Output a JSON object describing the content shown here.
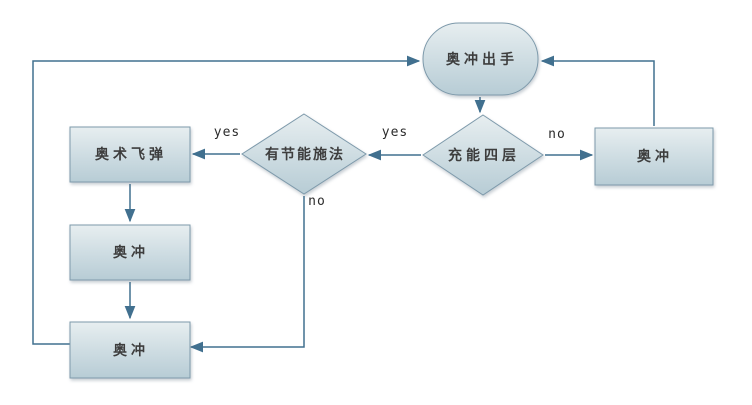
{
  "diagram": {
    "type": "flowchart",
    "background": "#ffffff",
    "colors": {
      "shape_fill_top": "#e7eef0",
      "shape_fill_bottom": "#b7ccd5",
      "shape_border": "#7e9aab",
      "connector": "#41708f",
      "node_text": "#3d3d3d",
      "edge_label_text": "#2b2b2b"
    },
    "nodes": {
      "start": {
        "type": "terminator",
        "label": "奥冲出手"
      },
      "charge_check": {
        "type": "decision",
        "label": "充能四层"
      },
      "clearcast_check": {
        "type": "decision",
        "label": "有节能施法"
      },
      "arcane_missiles": {
        "type": "process",
        "label": "奥术飞弹"
      },
      "surge_mid": {
        "type": "process",
        "label": "奥冲"
      },
      "surge_bottom": {
        "type": "process",
        "label": "奥冲"
      },
      "surge_right": {
        "type": "process",
        "label": "奥冲"
      }
    },
    "edge_labels": {
      "charge_yes": "yes",
      "charge_no": "no",
      "clearcast_yes": "yes",
      "clearcast_no": "no"
    },
    "edges": [
      {
        "from": "start",
        "to": "charge_check",
        "label": ""
      },
      {
        "from": "charge_check",
        "to": "clearcast_check",
        "label": "yes"
      },
      {
        "from": "charge_check",
        "to": "surge_right",
        "label": "no"
      },
      {
        "from": "clearcast_check",
        "to": "arcane_missiles",
        "label": "yes"
      },
      {
        "from": "clearcast_check",
        "to": "surge_bottom",
        "label": "no"
      },
      {
        "from": "arcane_missiles",
        "to": "surge_mid",
        "label": ""
      },
      {
        "from": "surge_mid",
        "to": "surge_bottom",
        "label": ""
      },
      {
        "from": "surge_bottom",
        "to": "start",
        "label": ""
      },
      {
        "from": "surge_right",
        "to": "start",
        "label": ""
      }
    ]
  }
}
